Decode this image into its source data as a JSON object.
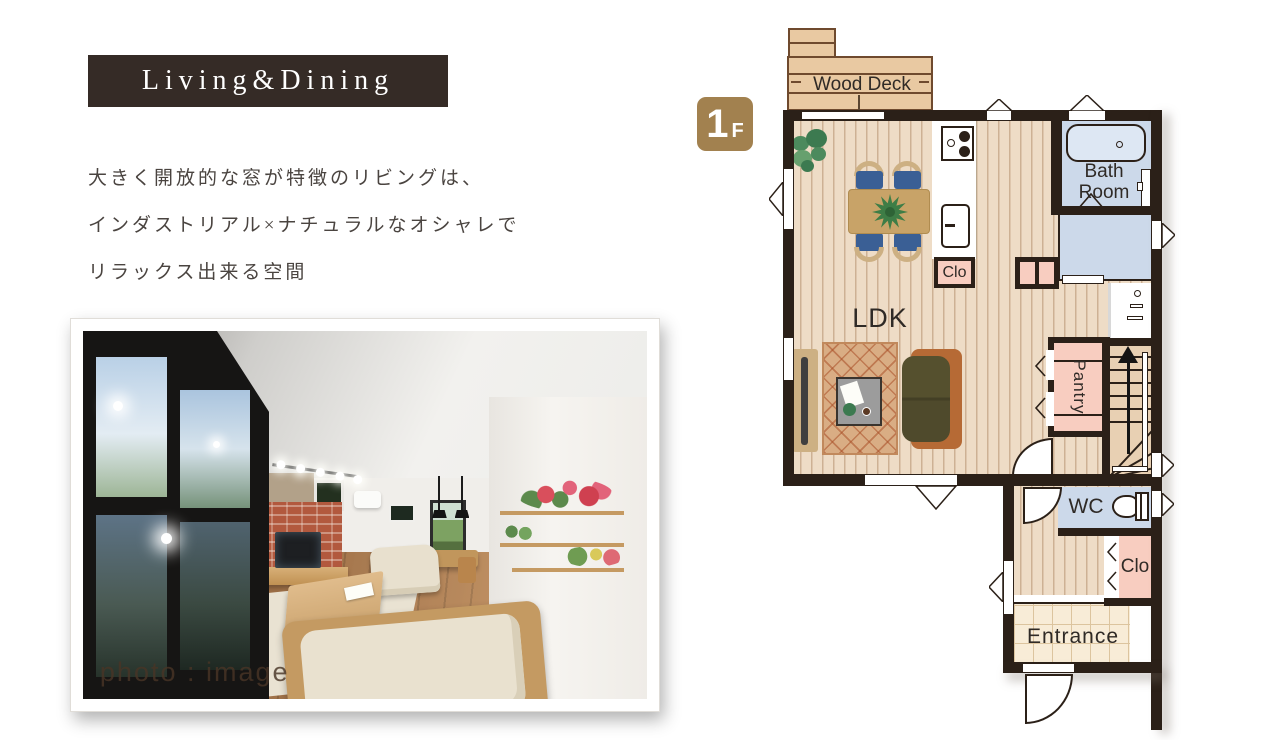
{
  "header": {
    "title": "Living&Dining"
  },
  "description": {
    "lines": [
      "大きく開放的な窓が特徴のリビングは、",
      "インダストリアル×ナチュラルなオシャレで",
      "リラックス出来る空間"
    ]
  },
  "photo": {
    "caption": "photo : image"
  },
  "floorplan": {
    "badge": {
      "number": "1",
      "suffix": "F"
    },
    "labels": {
      "wood_deck": "Wood Deck",
      "ldk": "LDK",
      "kitchen_closet": "Clo",
      "bath_line1": "Bath",
      "bath_line2": "Room",
      "pantry": "Pantry",
      "wc": "WC",
      "hall_closet": "Clo",
      "entrance": "Entrance"
    },
    "colors": {
      "wall": "#2b2018",
      "floor": "#eedcc6",
      "wet_room": "#ccd9ea",
      "closet_pink": "#f8cdc0",
      "entrance_tile": "#f8ecd7",
      "wood_deck": "#e9c9a2",
      "badge": "#a2814f",
      "dining_chair": "#3a5f95",
      "sofa": "#4f4a2c",
      "sofa_back": "#b66a35",
      "rug": "#d9ad84"
    }
  }
}
